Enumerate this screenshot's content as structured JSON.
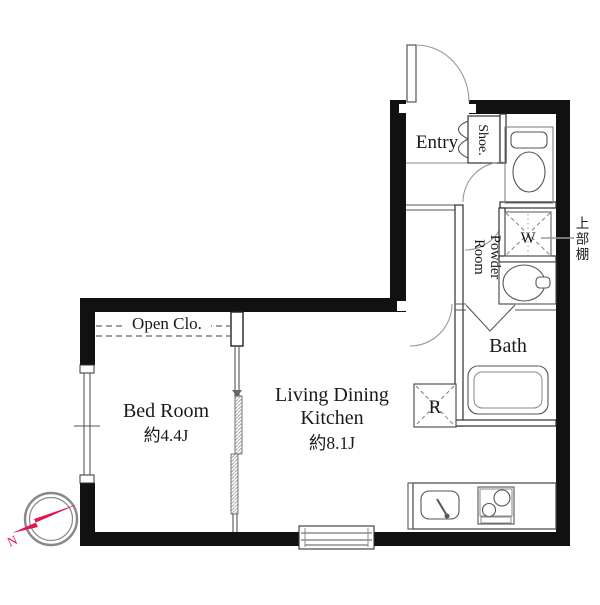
{
  "colors": {
    "wall": "#111111",
    "compass_arrow": "#e0174b"
  },
  "rooms": {
    "entry": {
      "label": "Entry"
    },
    "shoe_cabinet": {
      "label": "Shoe."
    },
    "powder_room": {
      "line1": "Powder",
      "line2": "Room"
    },
    "washing_machine": {
      "label": "W"
    },
    "upper_shelf": {
      "label": "上部棚"
    },
    "bath": {
      "label": "Bath"
    },
    "refrigerator": {
      "label": "R"
    },
    "living_dining_kitchen": {
      "line1": "Living Dining",
      "line2": "Kitchen",
      "size": "約8.1J"
    },
    "bed_room": {
      "label": "Bed Room",
      "size": "約4.4J"
    },
    "open_closet": {
      "label": "Open Clo."
    }
  },
  "compass": {
    "label": "N"
  }
}
